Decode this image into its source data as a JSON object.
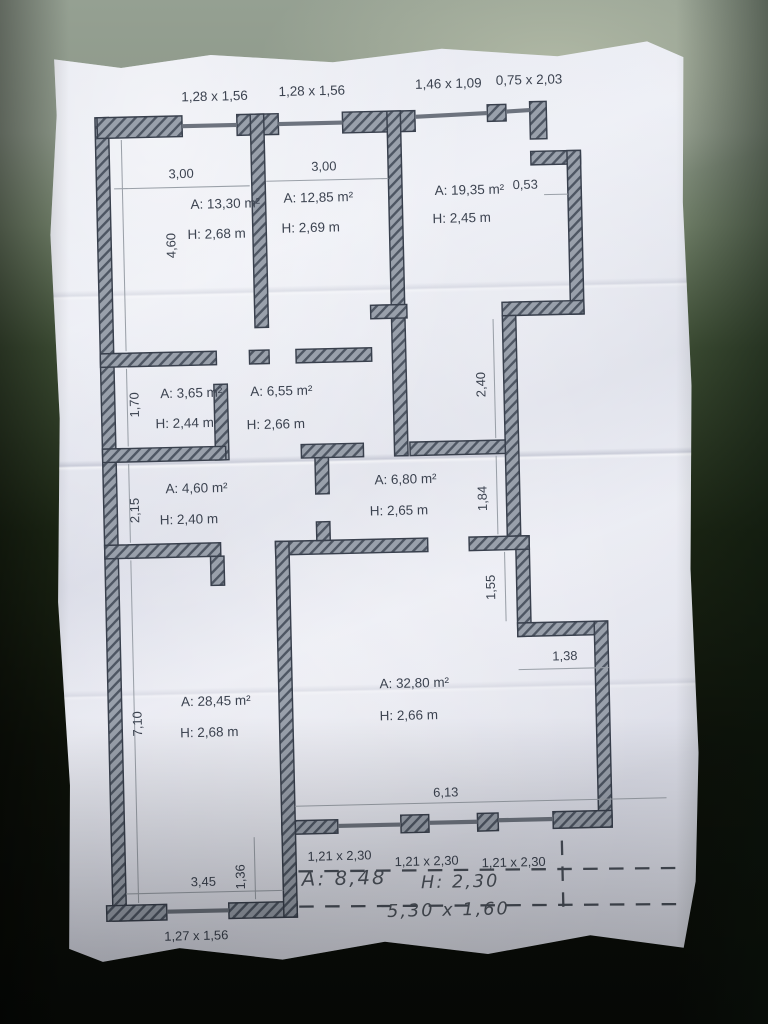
{
  "colors": {
    "paper": "#e9eaf2",
    "wall_fill": "#99a0ab",
    "wall_hatch": "#4e5663",
    "wall_outline": "#39404d",
    "ink": "#3c4350",
    "background_top": "#95a092",
    "background_bottom": "#090c08"
  },
  "plan": {
    "top_openings": [
      {
        "label": "1,28 x 1,56"
      },
      {
        "label": "1,28 x 1,56"
      },
      {
        "label": "1,46 x 1,09"
      },
      {
        "label": "0,75 x 2,03"
      }
    ],
    "rooms": [
      {
        "name": "room-13-30",
        "area": "A: 13,30 m²",
        "height": "H: 2,68 m"
      },
      {
        "name": "room-12-85",
        "area": "A: 12,85 m²",
        "height": "H: 2,69 m"
      },
      {
        "name": "room-19-35",
        "area": "A: 19,35 m²",
        "height": "H: 2,45 m"
      },
      {
        "name": "room-3-65",
        "area": "A: 3,65 m²",
        "height": "H: 2,44 m"
      },
      {
        "name": "room-6-55",
        "area": "A: 6,55 m²",
        "height": "H: 2,66 m"
      },
      {
        "name": "room-4-60",
        "area": "A: 4,60 m²",
        "height": "H: 2,40 m"
      },
      {
        "name": "room-6-80",
        "area": "A: 6,80 m²",
        "height": "H: 2,65 m"
      },
      {
        "name": "room-28-45",
        "area": "A: 28,45 m²",
        "height": "H: 2,68 m"
      },
      {
        "name": "room-32-80",
        "area": "A: 32,80 m²",
        "height": "H: 2,66 m"
      }
    ],
    "dims": {
      "room1_width": "3,00",
      "room2_width": "3,00",
      "notch": "0,53",
      "left_v1": "4,60",
      "left_v2": "1,70",
      "left_v3": "2,15",
      "left_v4": "7,10",
      "right_v1": "2,40",
      "right_v2": "1,84",
      "right_v3": "1,55",
      "step_width": "1,38",
      "bottom_width": "6,13",
      "bottom_left_width": "3,45",
      "bottom_left_v": "1,36",
      "bottom_left_window": "1,27 x 1,56"
    },
    "bottom_windows": [
      {
        "label": "1,21 x 2,30"
      },
      {
        "label": "1,21 x 2,30"
      },
      {
        "label": "1,21 x 2,30"
      }
    ],
    "handwritten": {
      "area": "A: 8,48",
      "height": "H: 2,30",
      "size": "5,30 x 1,60"
    }
  }
}
